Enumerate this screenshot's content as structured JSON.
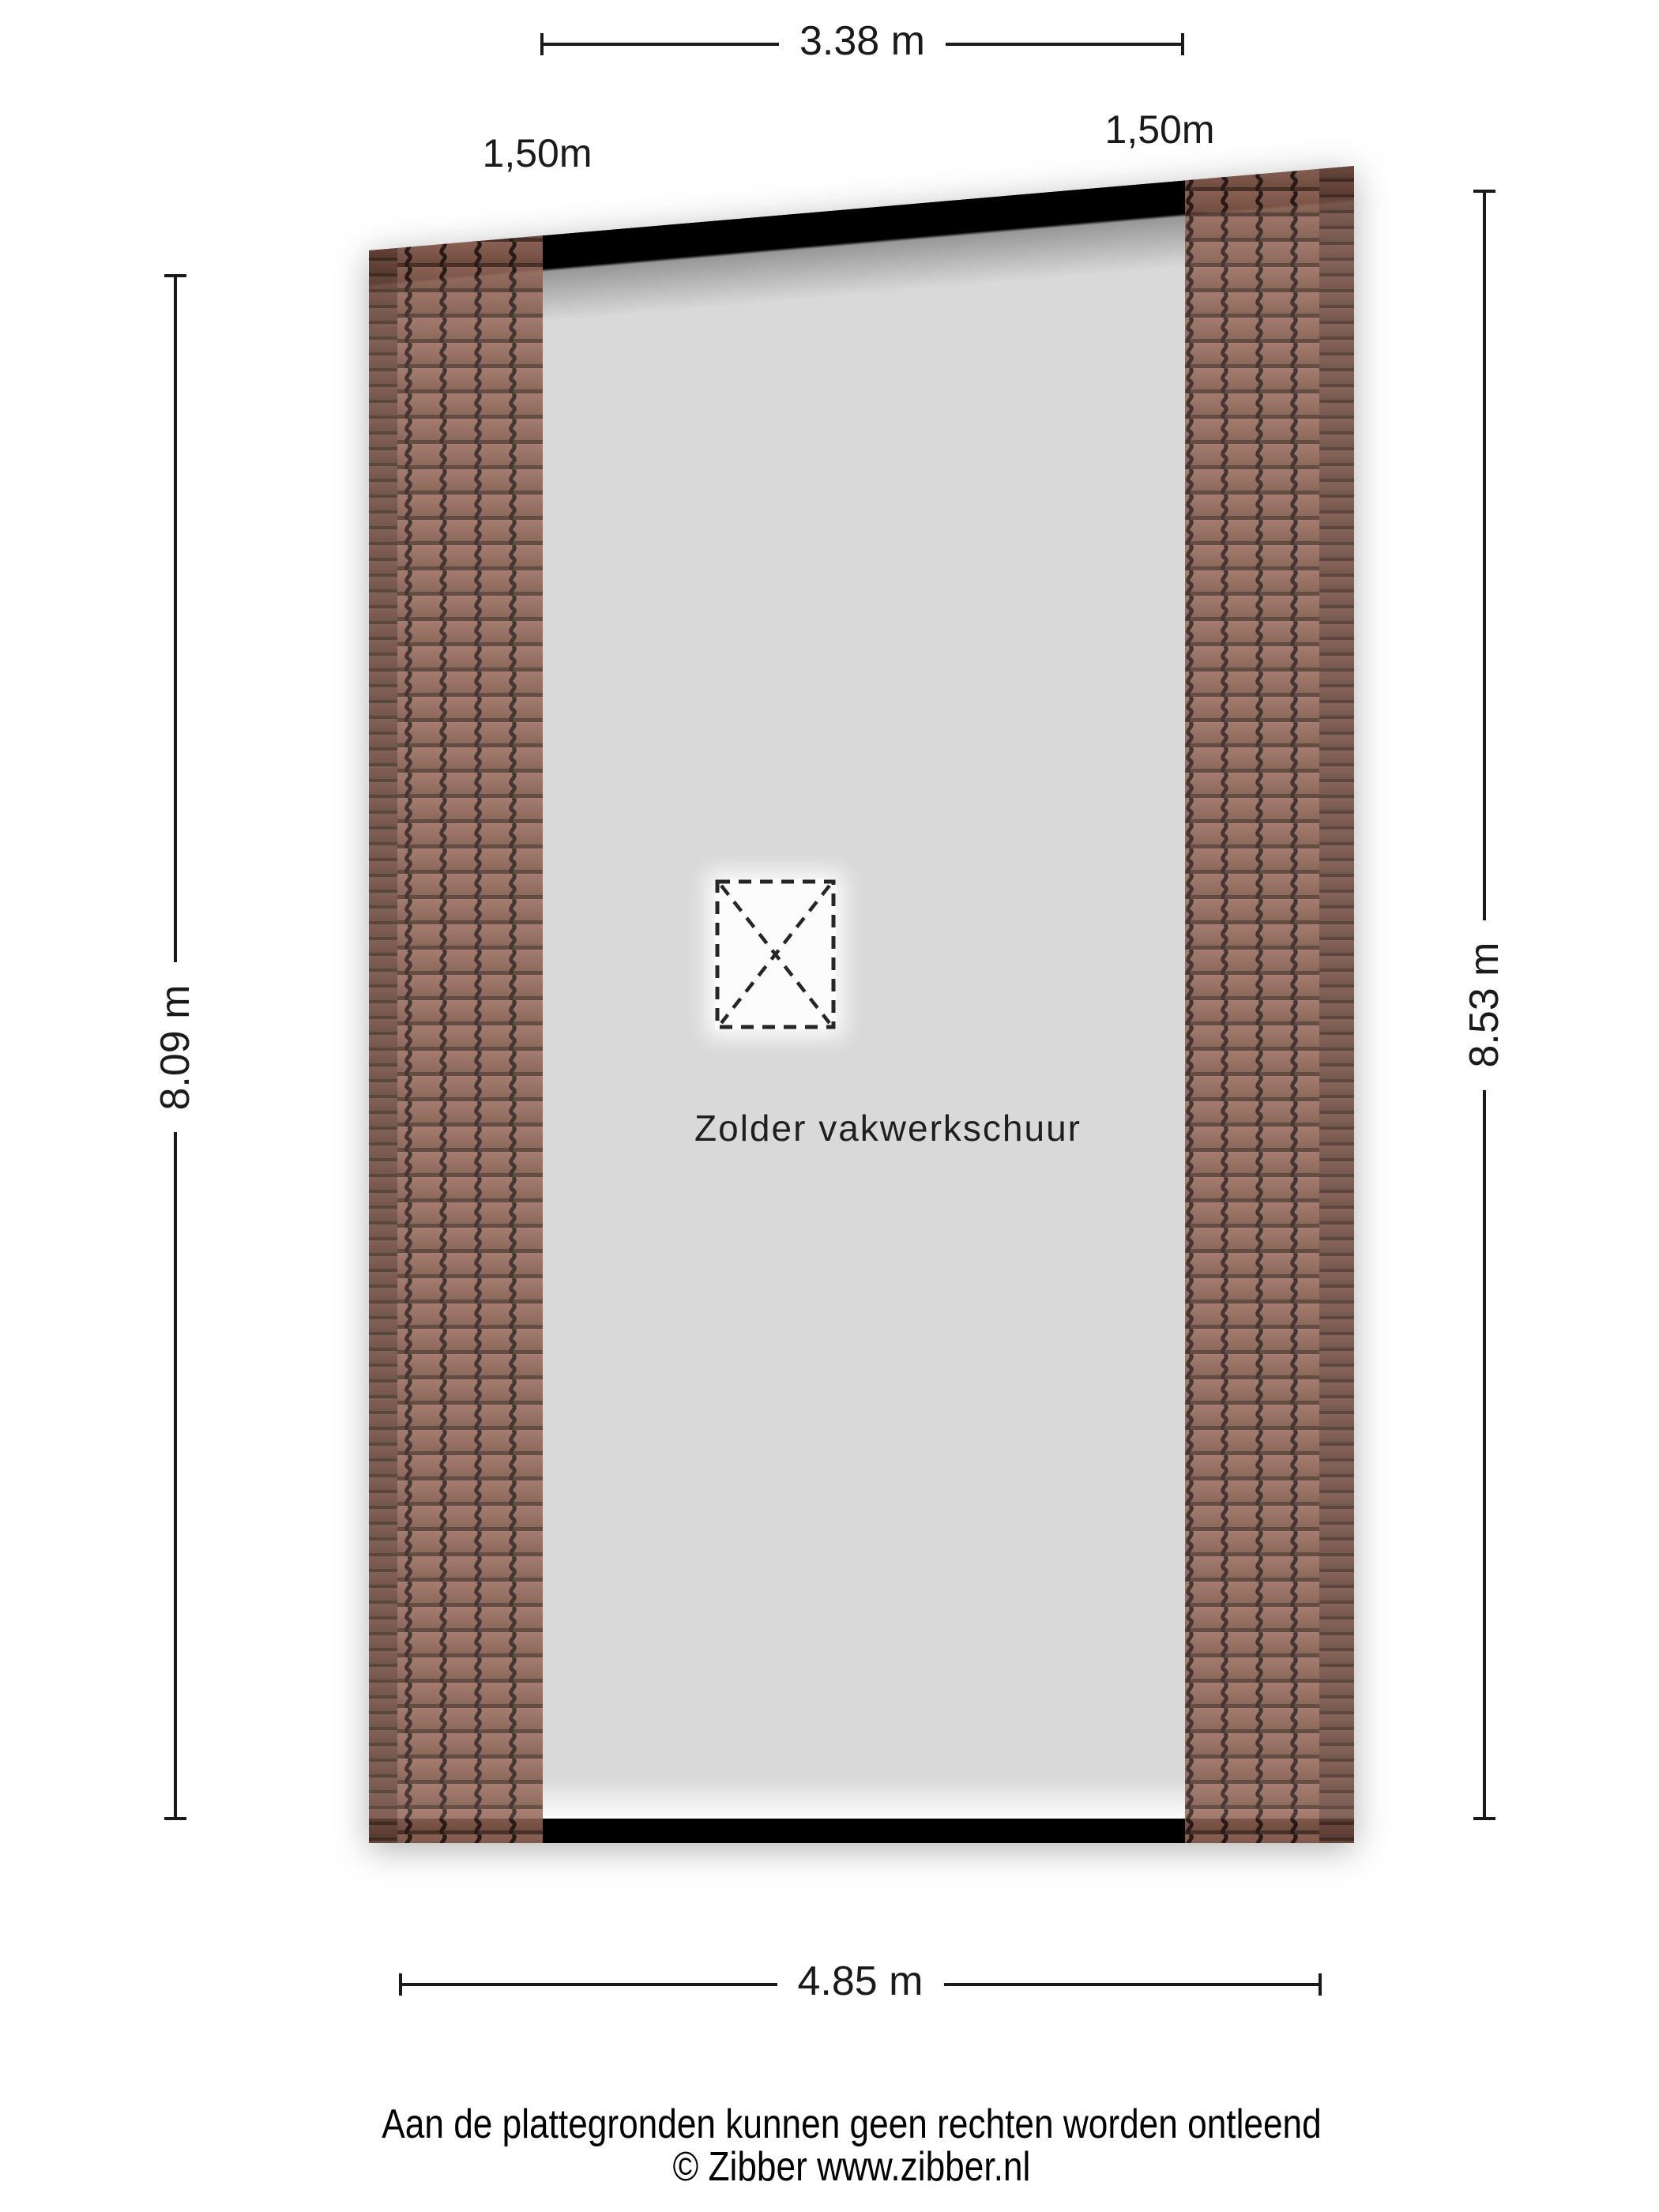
{
  "plan": {
    "room_label": "Zolder vakwerkschuur",
    "dimensions": {
      "top_width": "3.38 m",
      "bottom_width": "4.85 m",
      "left_height": "8.09 m",
      "right_height": "8.53 m",
      "roof_left": "1,50m",
      "roof_right": "1,50m"
    },
    "footer": {
      "disclaimer": "Aan de plattegronden kunnen geen rechten worden ontleend",
      "copyright": "© Zibber www.zibber.nl"
    },
    "colors": {
      "background": "#ffffff",
      "floor": "#d9d9d9",
      "wall": "#000000",
      "tile": "#8d6153",
      "tile_seam": "#33241f",
      "dimension_text": "#1a1a1a"
    }
  }
}
